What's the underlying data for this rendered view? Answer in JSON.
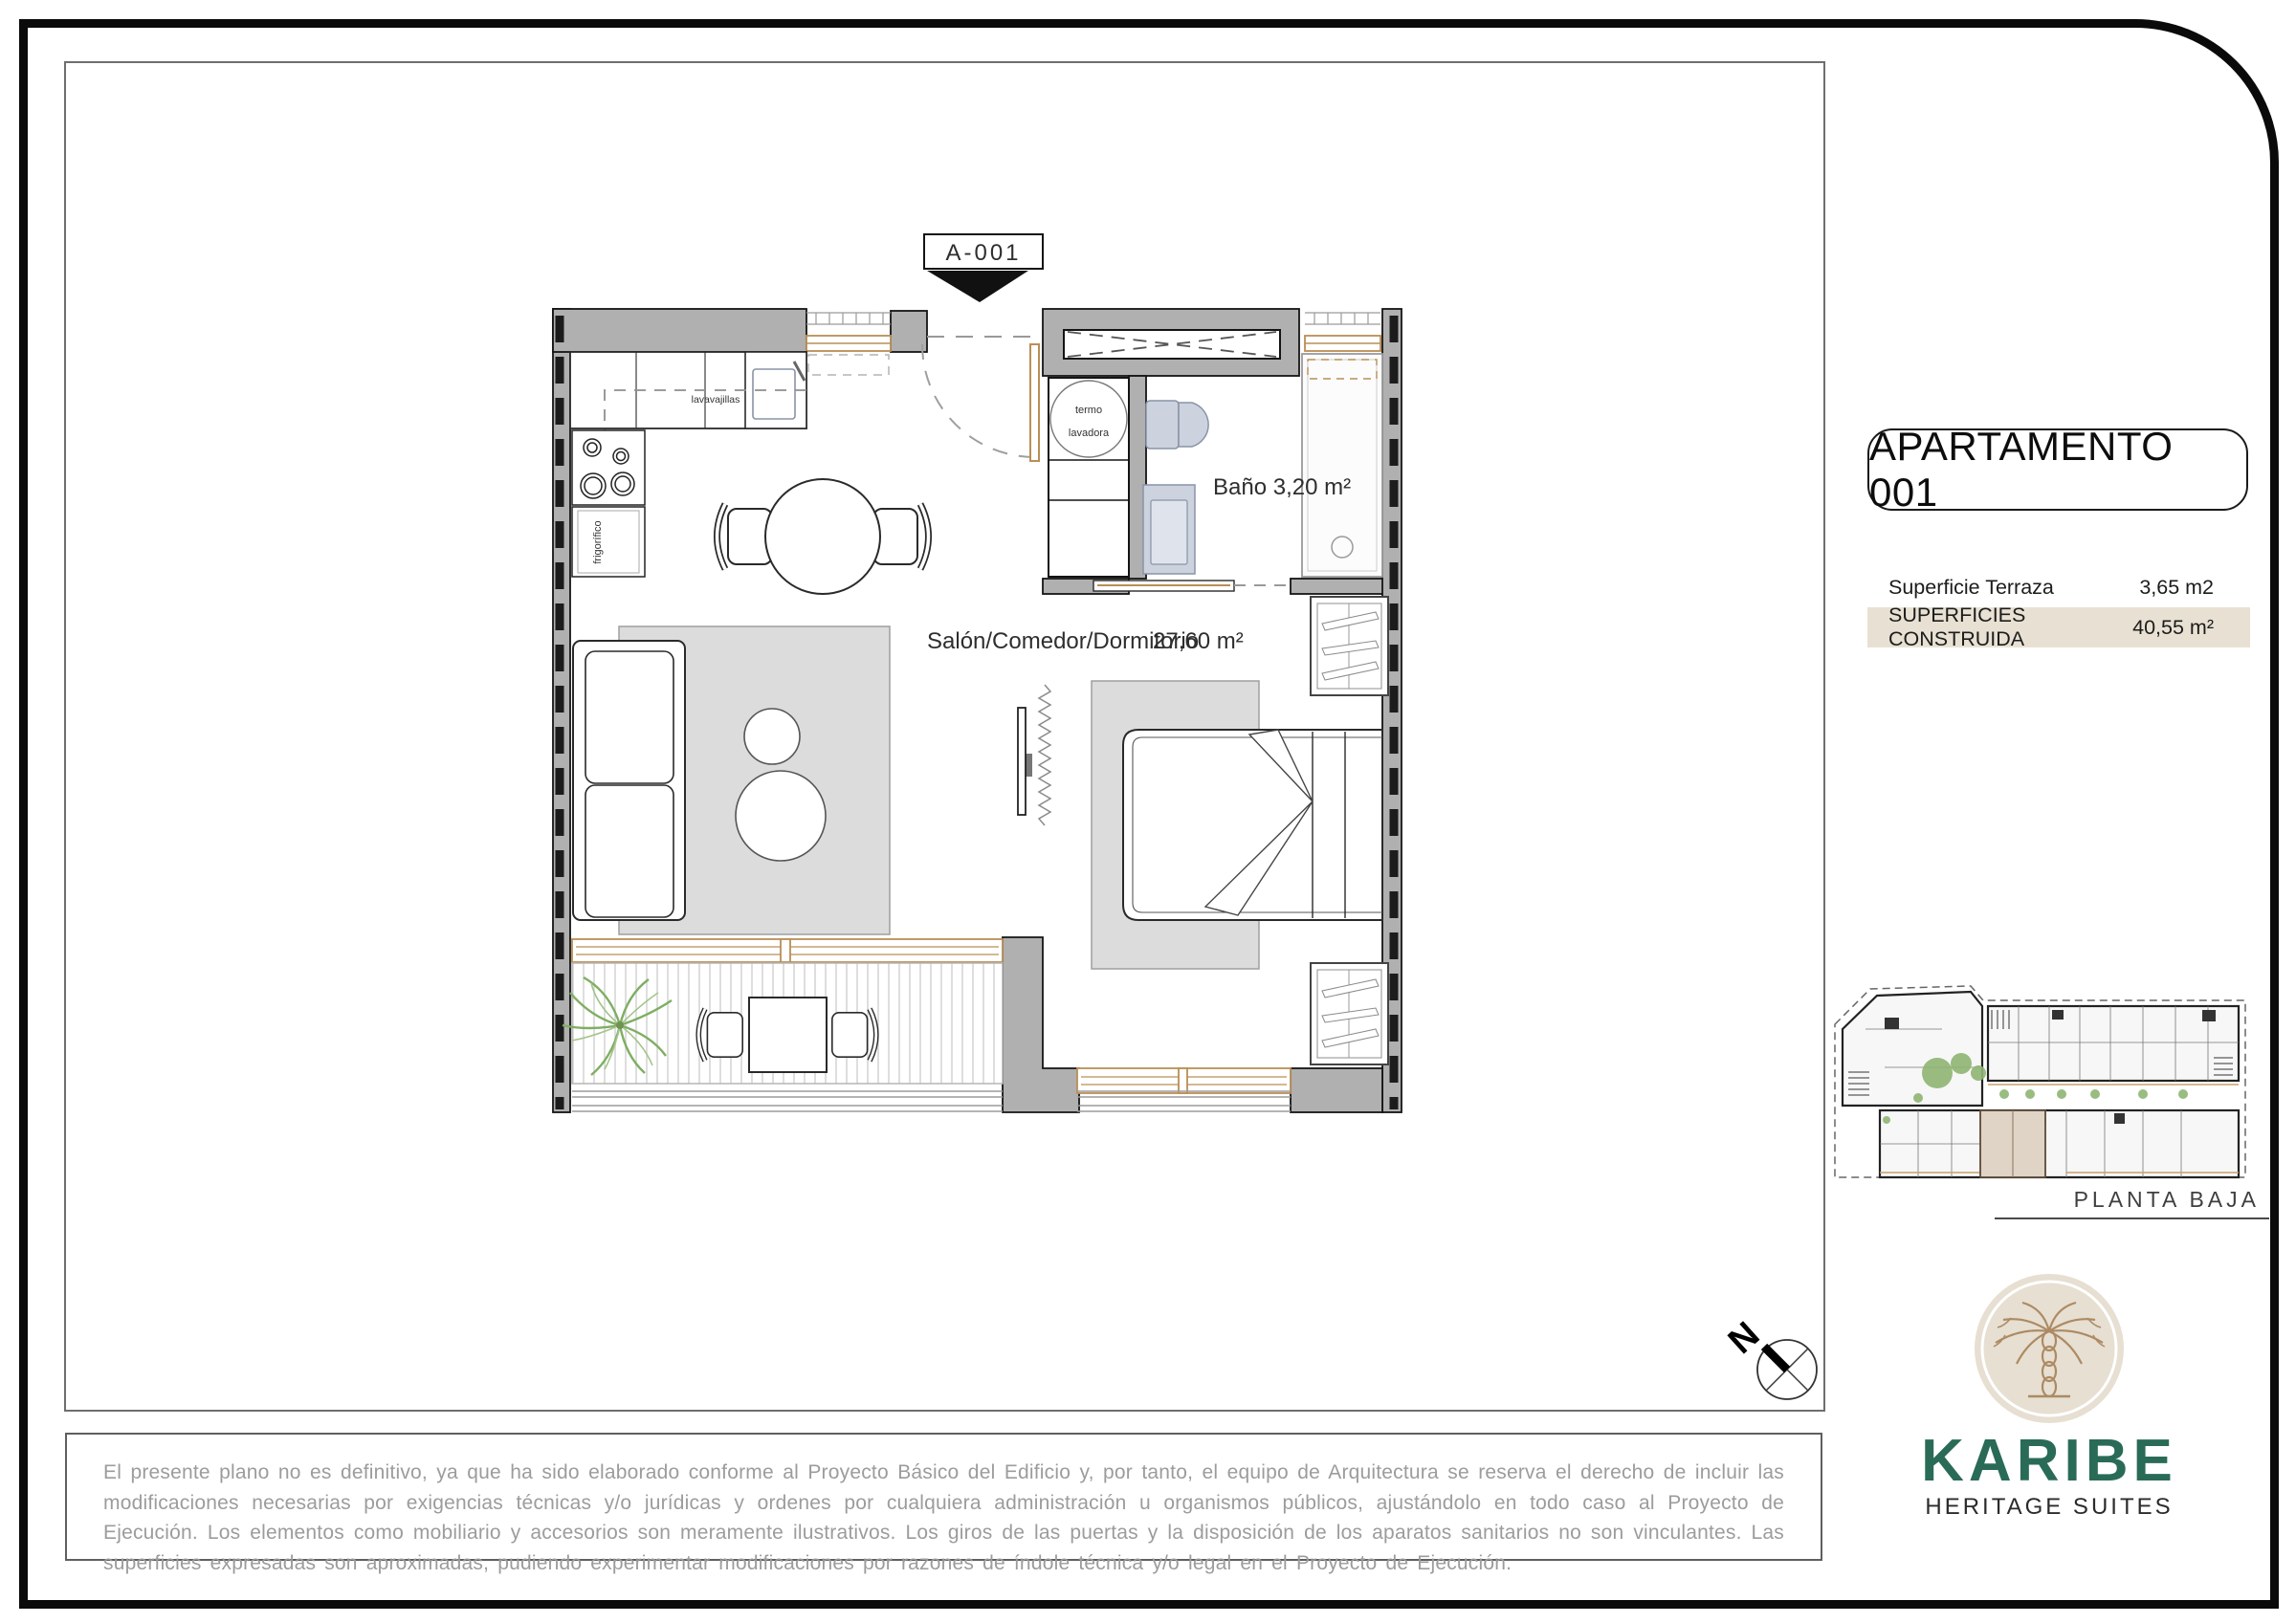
{
  "plan": {
    "marker": "A-001",
    "labels": {
      "bathroom": "Baño  3,20 m²",
      "living": "Salón/Comedor/Dormitorio",
      "living_area": "27,60 m²",
      "dishwasher": "lavavajillas",
      "boiler_top": "termo",
      "boiler_bottom": "lavadora",
      "fridge": "frigorífico"
    }
  },
  "panel": {
    "title": "APARTAMENTO 001",
    "rows": [
      {
        "label": "Superficie Terraza",
        "value": "3,65 m2"
      },
      {
        "label": "SUPERFICIES CONSTRUIDA",
        "value": "40,55 m²"
      }
    ],
    "floor_label": "PLANTA BAJA"
  },
  "compass": {
    "north": "N"
  },
  "brand": {
    "name": "KARIBE",
    "tagline": "HERITAGE SUITES"
  },
  "disclaimer": "El presente plano no es definitivo, ya que ha sido elaborado conforme al Proyecto Básico del Edificio y, por tanto, el equipo de Arquitectura se reserva el derecho de incluir las modificaciones necesarias por exigencias técnicas y/o jurídicas y ordenes por cualquiera administración u organismos públicos, ajustándolo en todo caso al Proyecto de Ejecución. Los elementos como mobiliario y accesorios son meramente ilustrativos. Los giros de las puertas y la disposición de los aparatos sanitarios no son vinculantes. Las superficies expresadas son aproximadas, pudiendo experimentar modificaciones por razones de índole técnica y/o legal en el Proyecto de Ejecución.",
  "colors": {
    "wall": "#b0b0b0",
    "wood_accent": "#b98f55",
    "fixture": "#ccd3df",
    "rug": "#dcdcdc",
    "table_highlight": "#e8e1d3",
    "brand_green": "#2a6b57",
    "plant_green": "#7fae63",
    "logo_beige": "#e6dfd2"
  }
}
